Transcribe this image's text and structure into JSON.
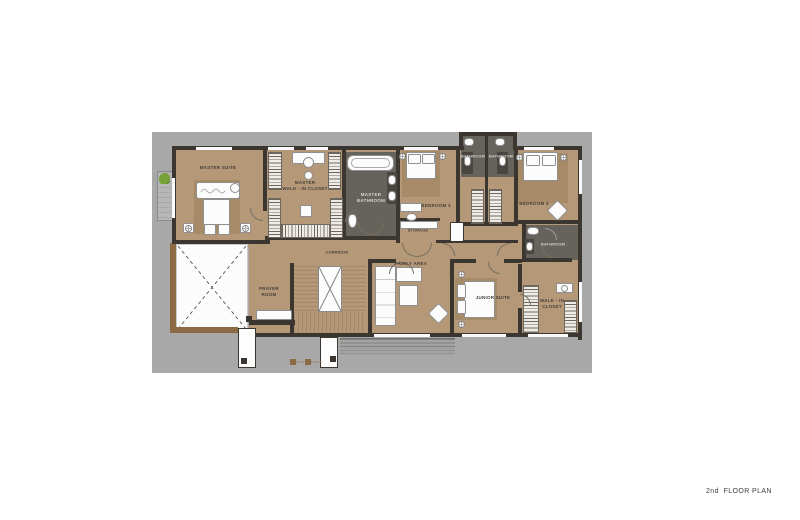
{
  "footer": {
    "label": "2nd  FLOOR PLAN"
  },
  "colors": {
    "backdrop": "#a8a8a8",
    "floor": "#b59878",
    "rug": "#a78a68",
    "wall": "#3b362f",
    "bath_floor": "#66625c",
    "white": "#fcfcfc",
    "wood": "#8d6a44",
    "plant": "#76a237",
    "label": "#45403a"
  },
  "plan": {
    "rooms": [
      {
        "id": "master-suite",
        "label": "MASTER SUITE"
      },
      {
        "id": "master-walk-in-closet",
        "label": "MASTER\nWALK - IN CLOSET"
      },
      {
        "id": "master-bathroom",
        "label": "MASTER\nBATHROOM"
      },
      {
        "id": "bedroom-3",
        "label": "BEDROOM 3"
      },
      {
        "id": "bathroom-3",
        "label": "BATHROOM"
      },
      {
        "id": "bathroom-4",
        "label": "BATHROOM"
      },
      {
        "id": "bedroom-4",
        "label": "BEDROOM 4"
      },
      {
        "id": "storage",
        "label": "STORAGE"
      },
      {
        "id": "corridor",
        "label": "CORRIDOR"
      },
      {
        "id": "prayer-room",
        "label": "PRAYER\nROOM"
      },
      {
        "id": "family-area",
        "label": "FAMILY AREA"
      },
      {
        "id": "junior-suite",
        "label": "JUNIOR SUITE"
      },
      {
        "id": "junior-bathroom",
        "label": "BATHROOM"
      },
      {
        "id": "junior-walk-in-closet",
        "label": "WALK - IN\nCLOSET"
      }
    ],
    "fixtures": [
      "bed",
      "pillow",
      "nightstand",
      "bathtub",
      "toilet",
      "sink",
      "vanity",
      "wardrobe",
      "sofa",
      "coffee-table",
      "lounge-chair",
      "stairs",
      "open-to-below-void",
      "planter-plant",
      "deck",
      "dressing-table",
      "stool"
    ]
  }
}
